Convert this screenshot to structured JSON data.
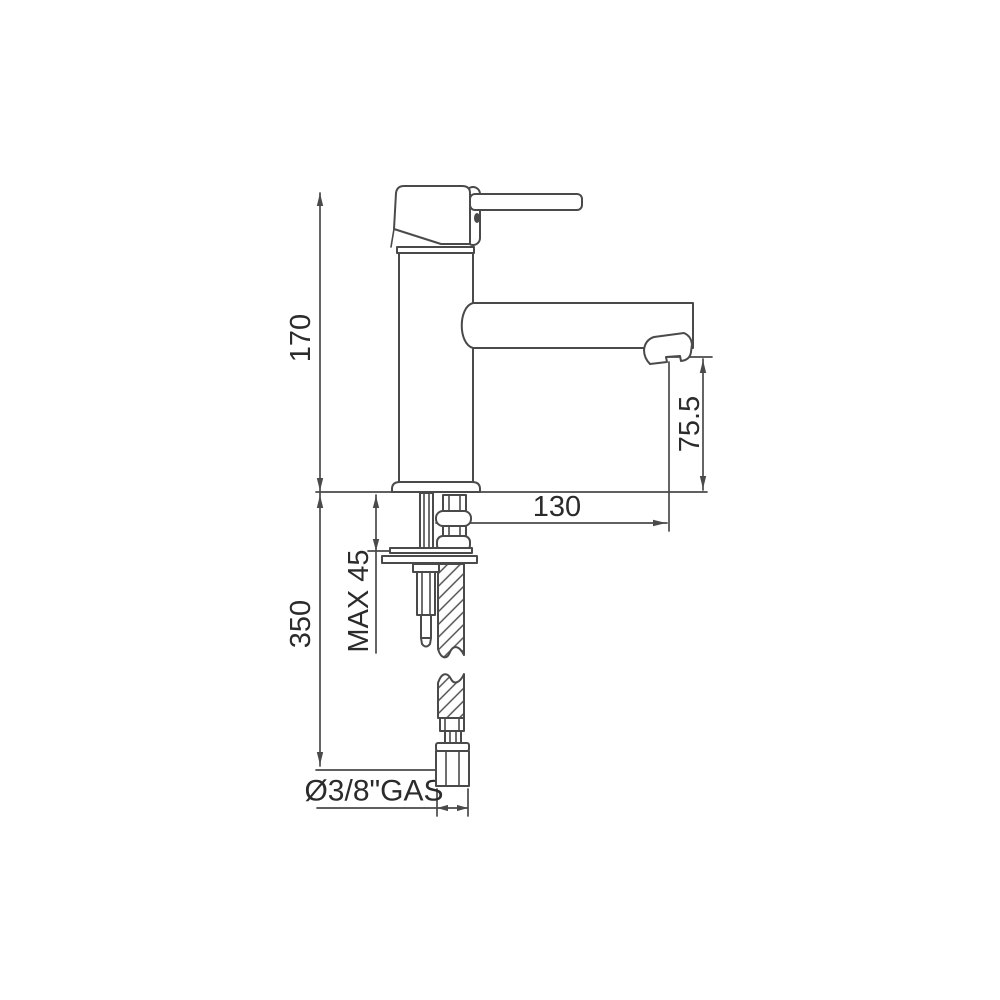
{
  "diagram": {
    "title": "basin-mixer-technical-drawing",
    "colors": {
      "background": "#ffffff",
      "line": "#4a4a4a",
      "text": "#2b2b2b"
    },
    "labels": {
      "overall_height": "170",
      "spout_outlet_height": "75.5",
      "spout_reach": "130",
      "max_mounting_thickness": "MAX 45",
      "below_deck_length": "350",
      "supply_connection": "Ø3/8\"GAS"
    }
  }
}
